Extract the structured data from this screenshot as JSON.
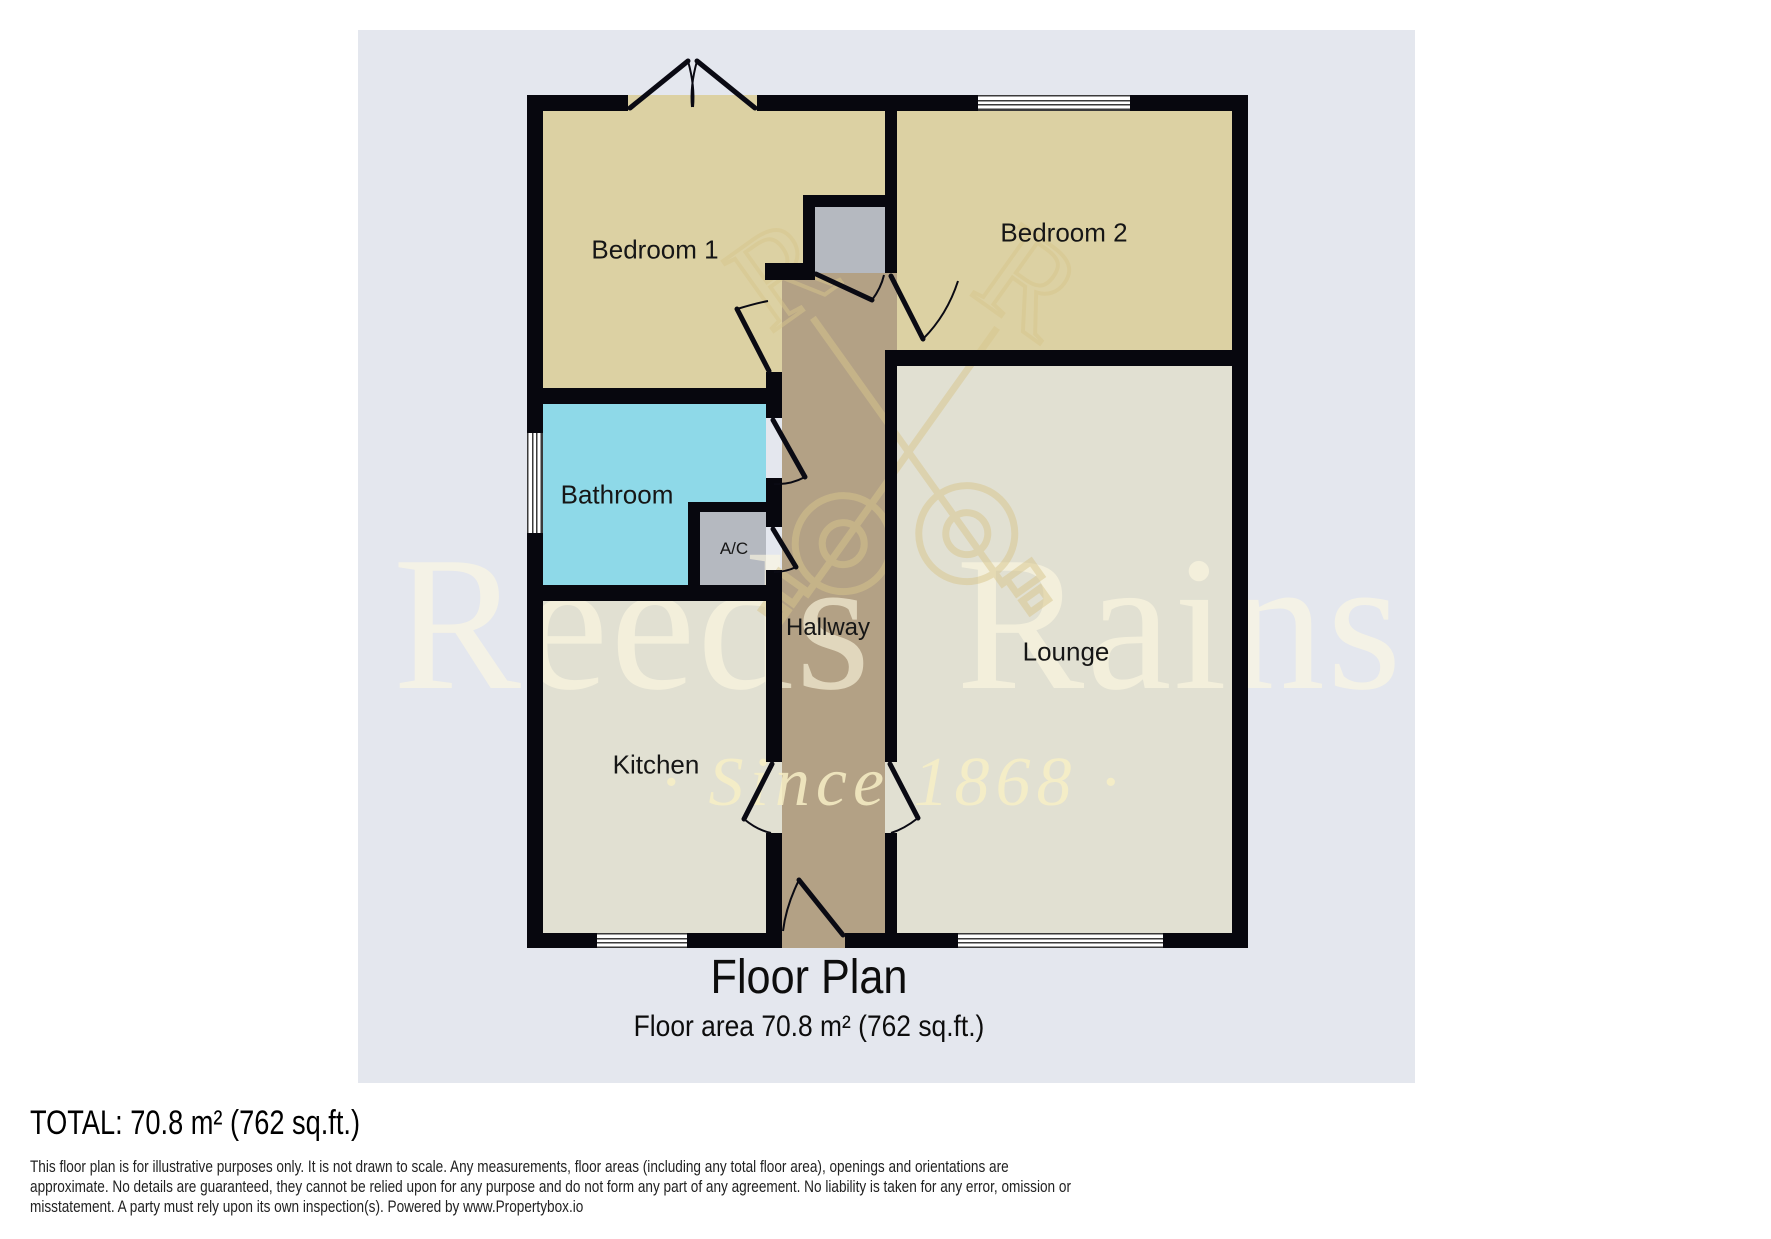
{
  "watermark": {
    "brand": "Reeds Rains",
    "tagline": "· Since 1868 ·",
    "monogram": "R"
  },
  "rooms": {
    "bedroom1": "Bedroom 1",
    "bedroom2": "Bedroom 2",
    "bathroom": "Bathroom",
    "ac": "A/C",
    "hallway": "Hallway",
    "lounge": "Lounge",
    "kitchen": "Kitchen"
  },
  "title": {
    "heading": "Floor Plan",
    "subheading": "Floor area 70.8 m² (762 sq.ft.)"
  },
  "footer": {
    "total": "TOTAL: 70.8 m² (762 sq.ft.)",
    "disclaimer_lines": [
      "This floor plan is for illustrative purposes only. It is not drawn to scale. Any measurements, floor areas (including any total floor area), openings and orientations are",
      "approximate. No details are guaranteed, they cannot be relied upon for any purpose and do not form any part of any agreement. No liability is taken for any error, omission or",
      "misstatement. A party must rely upon its own inspection(s). Powered by www.Propertybox.io"
    ]
  },
  "colors": {
    "wall": "#07070e",
    "panel": "#e4e7ee",
    "bedroom": "#dcd1a3",
    "bathroom": "#8ed9e8",
    "closet": "#b5b9c0",
    "hallway": "#b3a185",
    "living": "#e1e0d2",
    "watermark-gold": "#d8c68c"
  }
}
